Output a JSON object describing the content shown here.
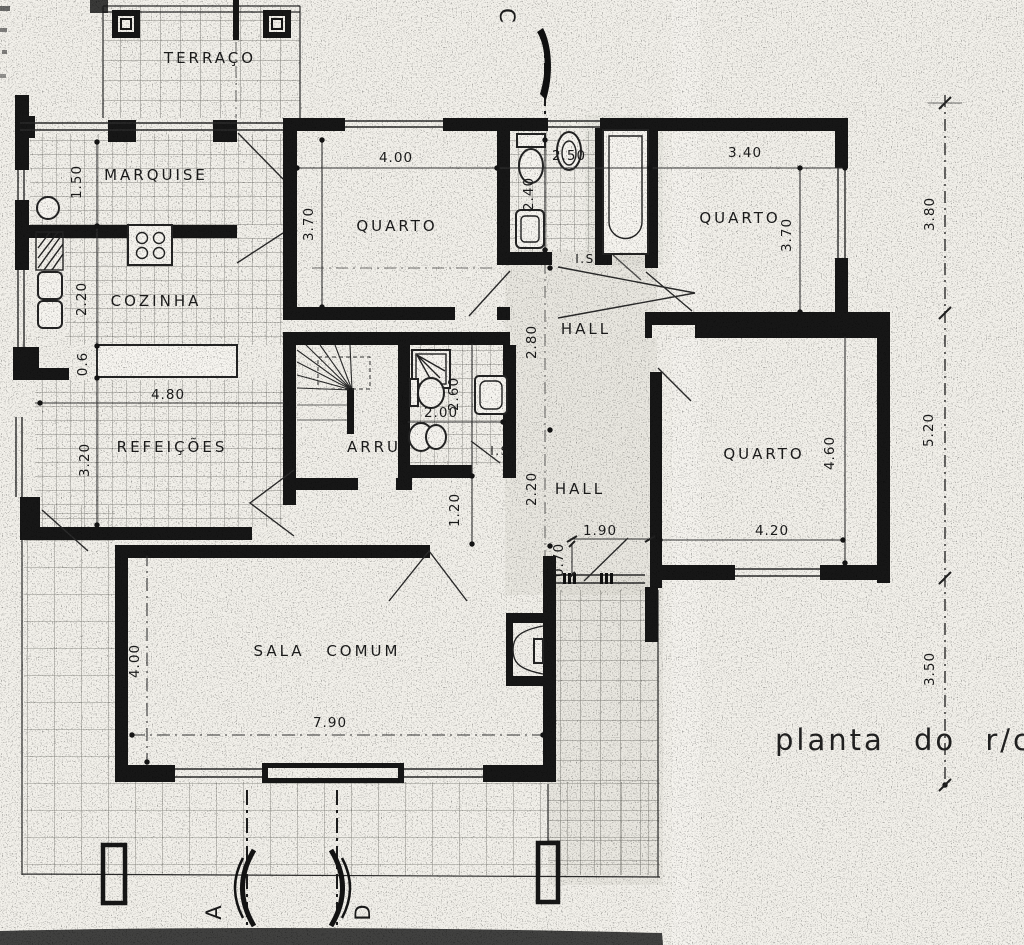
{
  "drawing": {
    "title": "planta do r/c",
    "rooms": {
      "terraco": "TERRAÇO",
      "marquise": "MARQUISE",
      "cozinha": "COZINHA",
      "refeicoes": "REFEIÇÕES",
      "quarto1": "QUARTO",
      "quarto2": "QUARTO",
      "quarto3": "QUARTO",
      "hall1": "HALL",
      "hall2": "HALL",
      "arru": "ARRU",
      "sala": "SALA COMUM",
      "is1": "I.S",
      "is2": "I.S"
    },
    "dimensions": {
      "quarto1_width": "4.00",
      "quarto1_height": "3.70",
      "bath1_width": "2.50",
      "bath1_height": "2.40",
      "quarto2_width": "3.40",
      "quarto2_height": "3.70",
      "ext_right_top": "3.80",
      "marquise_height": "1.50",
      "cozinha_height": "2.20",
      "counter_depth": "0.6",
      "refeicoes_width": "4.80",
      "refeicoes_height": "3.20",
      "hall1_height": "2.80",
      "bath2_width": "2.00",
      "bath2_height": "2.60",
      "hall2_height": "2.20",
      "passage_width": "1.20",
      "entry_width": "1.90",
      "entry_depth": "0.70",
      "quarto3_height": "4.60",
      "quarto3_width": "4.20",
      "ext_right_mid": "5.20",
      "sala_height": "4.00",
      "sala_width": "7.90",
      "ext_right_bottom": "3.50"
    },
    "sections": {
      "top": "C",
      "bottom_left": "A",
      "bottom_right": "D"
    }
  }
}
